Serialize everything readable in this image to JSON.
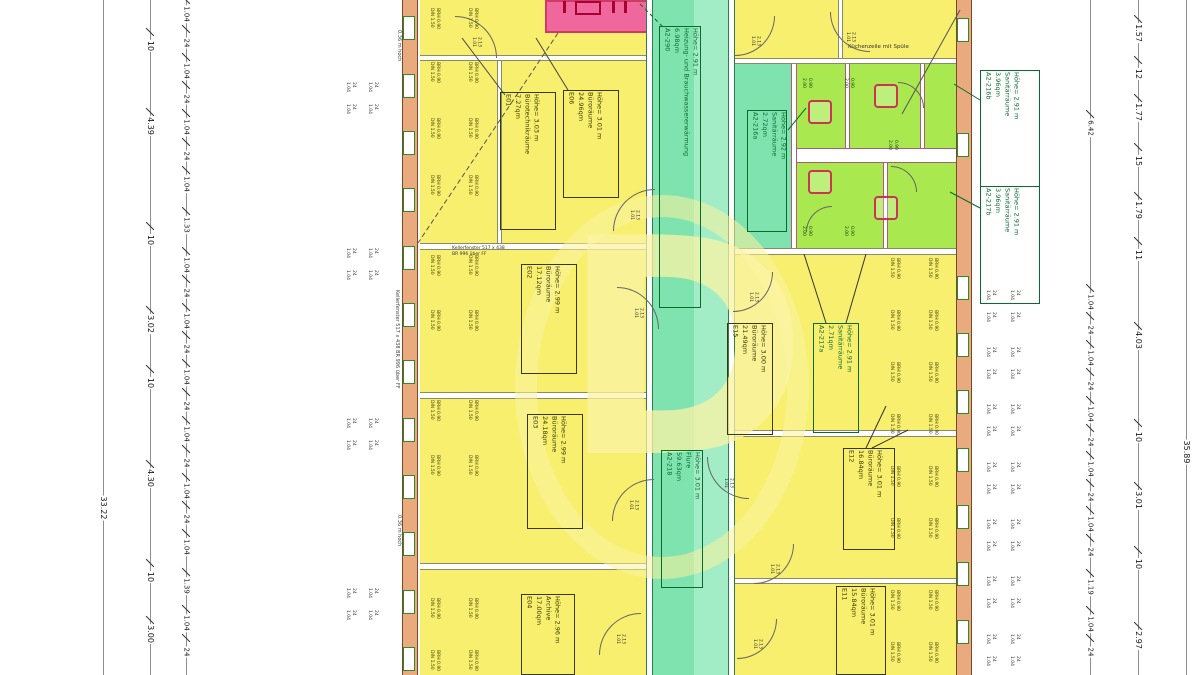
{
  "watermark": {
    "letter": "D"
  },
  "dimensions": {
    "left_total": "33.22",
    "right_total": "35.89"
  },
  "rooms": {
    "e01": {
      "id": "E01",
      "area": "7.27qm",
      "use": "Bürotechnikräume",
      "height": "Höhe= 3.03 m"
    },
    "e06": {
      "id": "E06",
      "area": "24.96qm",
      "use": "Büroräume",
      "height": "Höhe= 3.01 m"
    },
    "e02": {
      "id": "E02",
      "area": "17.12qm",
      "use": "Büroräume",
      "height": "Höhe= 2.99 m"
    },
    "e03": {
      "id": "E03",
      "area": "24.18qm",
      "use": "Büroräume",
      "height": "Höhe= 2.99 m"
    },
    "e04": {
      "id": "E04",
      "area": "17.00qm",
      "use": "Archive",
      "height": "Höhe= 2.96 m"
    },
    "e15": {
      "id": "E15",
      "area": "21.49qm",
      "use": "Büroräume",
      "height": "Höhe= 3.00 m"
    },
    "e12": {
      "id": "E12",
      "area": "16.84qm",
      "use": "Büroräume",
      "height": "Höhe= 3.01 m"
    },
    "e11": {
      "id": "E11",
      "area": "15.84qm",
      "use": "Büroräume",
      "height": "Höhe= 3.01 m"
    },
    "heating": {
      "id": "A2-290",
      "area": "6.98qm",
      "use": "Heizung- und Brauchwassererwärmung",
      "height": "Höhe= 2.91 m"
    },
    "flur": {
      "id": "A2-218",
      "area": "59.63qm",
      "use": "Flure",
      "height": "Höhe= 3.01 m"
    },
    "san216a": {
      "id": "A2-216a",
      "area": "2.72qm",
      "use": "Sanitärräume",
      "height": "Höhe= 2.92 m"
    },
    "san216b": {
      "id": "A2-216b",
      "area": "3.96qm",
      "use": "Sanitärräume",
      "height": "Höhe= 2.91 m"
    },
    "san217a": {
      "id": "A2-217a",
      "area": "2.71qm",
      "use": "Sanitärräume",
      "height": "Höhe= 2.91 m"
    },
    "san217b": {
      "id": "A2-217b",
      "area": "3.96qm",
      "use": "Sanitärräume",
      "height": "Höhe= 2.91 m"
    }
  },
  "annotations": {
    "kitchen_note": "Küchenzeile mit Spüle",
    "window_note_line1": "Kellerfenster 517 x 438",
    "window_note_line2": "BR 996 über FF",
    "window_note_vertical": "Kellerfenster 517 x 438  BR 996 über FF",
    "sill_note": "0.36 m hoch"
  },
  "generated": {
    "dim_chains": [
      {
        "name": "left-main",
        "x": 150,
        "fs": 8,
        "items": [
          {
            "t": "10",
            "y": 46
          },
          {
            "t": "4.39",
            "y": 126
          },
          {
            "t": "10",
            "y": 240
          },
          {
            "t": "3.02",
            "y": 324
          },
          {
            "t": "10",
            "y": 383
          },
          {
            "t": "4.30",
            "y": 478
          },
          {
            "t": "10",
            "y": 577
          },
          {
            "t": "3.00",
            "y": 634
          }
        ]
      },
      {
        "name": "left-window",
        "x": 186,
        "fs": 7,
        "items": [
          {
            "t": "1.04",
            "y": 14
          },
          {
            "t": "24",
            "y": 43
          },
          {
            "t": "1.04",
            "y": 71
          },
          {
            "t": "24",
            "y": 99
          },
          {
            "t": "1.04",
            "y": 127
          },
          {
            "t": "24",
            "y": 156
          },
          {
            "t": "1.04",
            "y": 184
          },
          {
            "t": "1.33",
            "y": 225
          },
          {
            "t": "1.04",
            "y": 265
          },
          {
            "t": "24",
            "y": 293
          },
          {
            "t": "1.04",
            "y": 321
          },
          {
            "t": "24",
            "y": 349
          },
          {
            "t": "1.04",
            "y": 377
          },
          {
            "t": "24",
            "y": 406
          },
          {
            "t": "1.04",
            "y": 434
          },
          {
            "t": "24",
            "y": 463
          },
          {
            "t": "1.04",
            "y": 491
          },
          {
            "t": "24",
            "y": 519
          },
          {
            "t": "1.04",
            "y": 547
          },
          {
            "t": "1.39",
            "y": 586
          },
          {
            "t": "1.04",
            "y": 623
          },
          {
            "t": "24",
            "y": 652
          }
        ]
      },
      {
        "name": "right-window",
        "x": 1090,
        "fs": 7,
        "items": [
          {
            "t": "6.42",
            "y": 128
          },
          {
            "t": "1.04",
            "y": 302
          },
          {
            "t": "24",
            "y": 330
          },
          {
            "t": "1.04",
            "y": 358
          },
          {
            "t": "24",
            "y": 386
          },
          {
            "t": "1.04",
            "y": 414
          },
          {
            "t": "24",
            "y": 442
          },
          {
            "t": "1.04",
            "y": 469
          },
          {
            "t": "24",
            "y": 497
          },
          {
            "t": "1.04",
            "y": 524
          },
          {
            "t": "24",
            "y": 552
          },
          {
            "t": "1.19",
            "y": 587
          },
          {
            "t": "1.04",
            "y": 624
          },
          {
            "t": "24",
            "y": 652
          }
        ]
      },
      {
        "name": "right-main",
        "x": 1138,
        "fs": 8,
        "items": [
          {
            "t": "1.57",
            "y": 33
          },
          {
            "t": "12",
            "y": 74
          },
          {
            "t": "1.77",
            "y": 112
          },
          {
            "t": "15",
            "y": 161
          },
          {
            "t": "1.79",
            "y": 210
          },
          {
            "t": "11",
            "y": 255
          },
          {
            "t": "4.03",
            "y": 340
          },
          {
            "t": "10",
            "y": 437
          },
          {
            "t": "3.01",
            "y": 500
          },
          {
            "t": "10",
            "y": 564
          },
          {
            "t": "2.97",
            "y": 640
          }
        ]
      }
    ],
    "outside_marks": [
      {
        "side": "left",
        "xs": [
          344,
          366
        ],
        "ys": [
          82,
          104,
          248,
          270,
          418,
          440,
          588,
          610
        ],
        "lines": [
          "1.04",
          "24"
        ]
      },
      {
        "side": "right",
        "xs": [
          984,
          1008
        ],
        "ys": [
          290,
          312,
          347,
          369,
          404,
          426,
          462,
          484,
          519,
          541,
          576,
          598,
          634,
          656
        ],
        "lines": [
          "1.04",
          "24"
        ]
      }
    ],
    "win_specs": [
      {
        "side": "left",
        "cols": [
          428,
          466
        ],
        "rows": [
          8,
          62,
          118,
          175,
          255,
          310,
          400,
          455,
          598,
          650
        ],
        "lines": [
          "DIN 1.50",
          "BRH 0.90"
        ]
      },
      {
        "side": "right",
        "cols": [
          888,
          926
        ],
        "rows": [
          258,
          310,
          362,
          414,
          466,
          518,
          590,
          642
        ],
        "lines": [
          "DIN 1.50",
          "BRH 0.90"
        ]
      }
    ],
    "san_marks": {
      "positions": [
        [
          800,
          78
        ],
        [
          842,
          78
        ],
        [
          886,
          140
        ],
        [
          800,
          226
        ],
        [
          842,
          226
        ]
      ],
      "lines": [
        "2.00",
        "0.90"
      ]
    },
    "windows": [
      {
        "side": "left",
        "x": 403,
        "ys": [
          28,
          86,
          143,
          200,
          258,
          315,
          372,
          430,
          487,
          544,
          602,
          659
        ]
      },
      {
        "side": "right",
        "x": 957,
        "ys": [
          30,
          145,
          288,
          345,
          402,
          460,
          517,
          574,
          632
        ]
      }
    ],
    "doors": {
      "width_label": "1.01",
      "height_label": "2.13",
      "arcs": [
        {
          "x": 455,
          "y": 16,
          "s": 42,
          "r": 90
        },
        {
          "x": 613,
          "y": 189,
          "s": 42,
          "r": 0
        },
        {
          "x": 617,
          "y": 287,
          "s": 42,
          "r": 90
        },
        {
          "x": 612,
          "y": 479,
          "s": 42,
          "r": 0
        },
        {
          "x": 733,
          "y": 272,
          "s": 40,
          "r": 180
        },
        {
          "x": 707,
          "y": 457,
          "s": 42,
          "r": 270
        },
        {
          "x": 754,
          "y": 544,
          "s": 40,
          "r": 180
        },
        {
          "x": 599,
          "y": 613,
          "s": 42,
          "r": 0
        },
        {
          "x": 737,
          "y": 619,
          "s": 40,
          "r": 180
        },
        {
          "x": 830,
          "y": 12,
          "s": 40,
          "r": 270
        },
        {
          "x": 735,
          "y": 16,
          "s": 40,
          "r": 180
        },
        {
          "x": 898,
          "y": 82,
          "s": 26,
          "r": 90
        },
        {
          "x": 891,
          "y": 166,
          "s": 26,
          "r": 90
        },
        {
          "x": 806,
          "y": 206,
          "s": 26,
          "r": 0
        }
      ]
    },
    "fixtures": [
      [
        808,
        100
      ],
      [
        808,
        170
      ],
      [
        874,
        84
      ],
      [
        874,
        196
      ]
    ]
  }
}
